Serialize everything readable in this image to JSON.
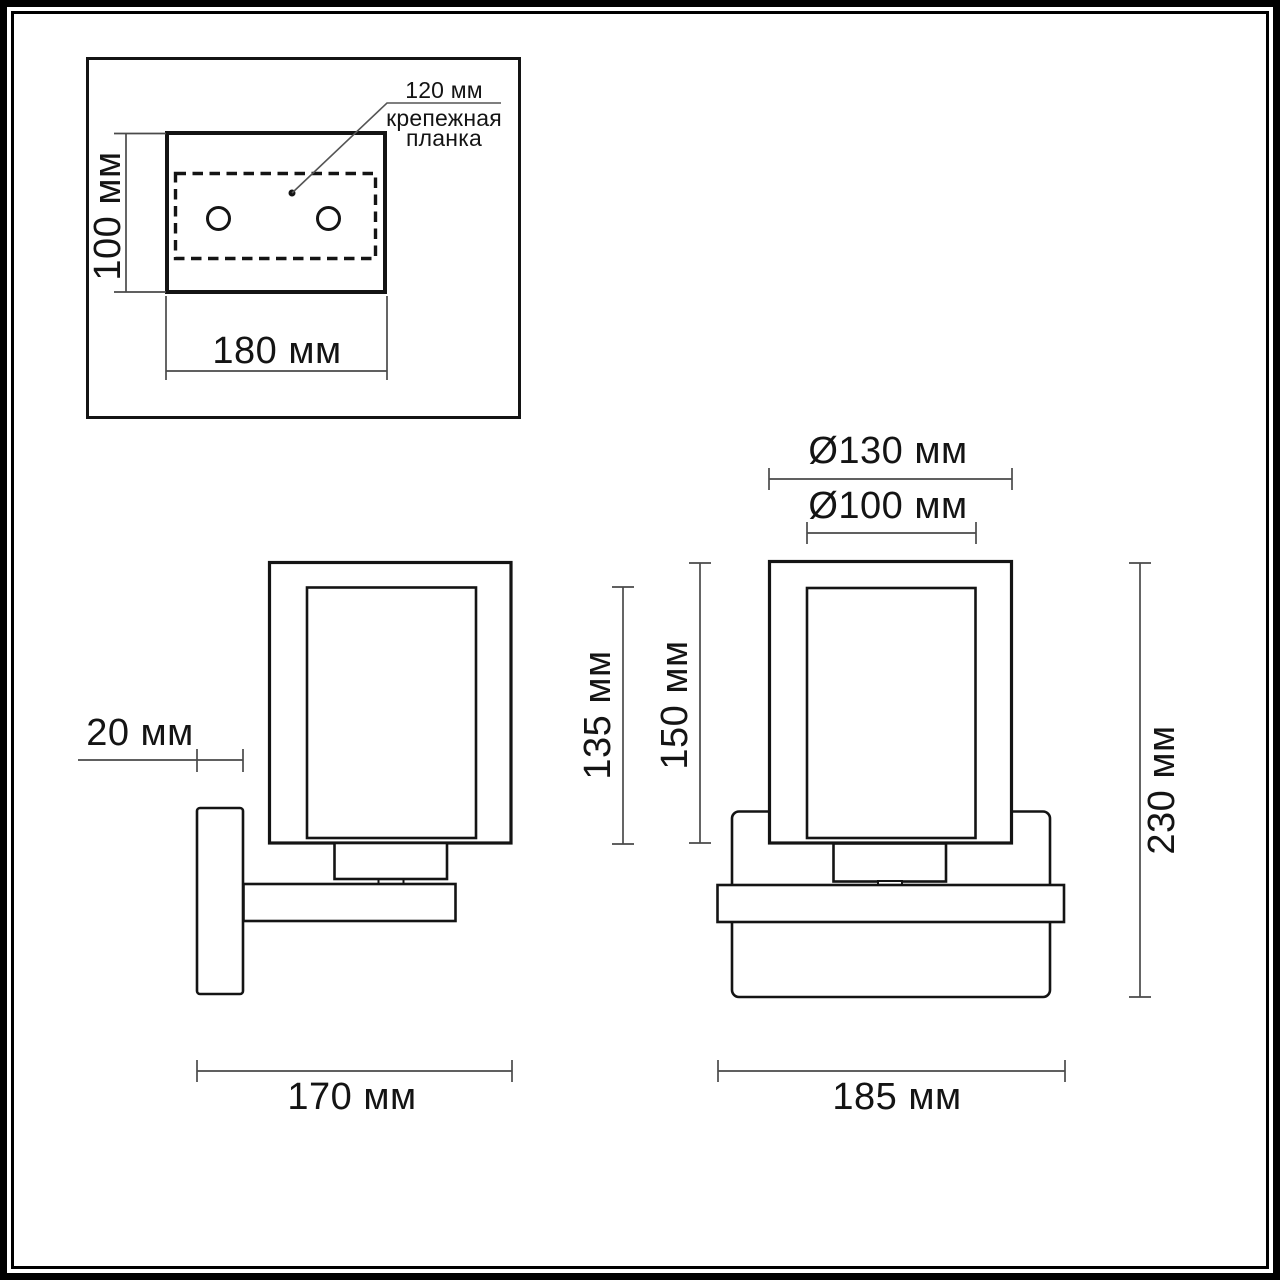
{
  "drawing": {
    "type": "technical-dimension-drawing",
    "subject": "wall sconce installation drawing",
    "colors": {
      "line": "#141414",
      "dim_line": "#4a4a4a",
      "background": "#ffffff"
    },
    "mounting_plan": {
      "height_label": "100 мм",
      "width_label": "180 мм",
      "holes_label": "120 мм",
      "bracket_label_line1": "крепежная",
      "bracket_label_line2": "планка"
    },
    "side_view": {
      "depth_label": "20 мм",
      "width_label": "170 мм"
    },
    "front_view": {
      "outer_diameter_label": "Ø130 мм",
      "inner_diameter_label": "Ø100 мм",
      "inner_height_label": "135 мм",
      "shade_height_label": "150 мм",
      "total_height_label": "230 мм",
      "width_label": "185 мм"
    }
  }
}
